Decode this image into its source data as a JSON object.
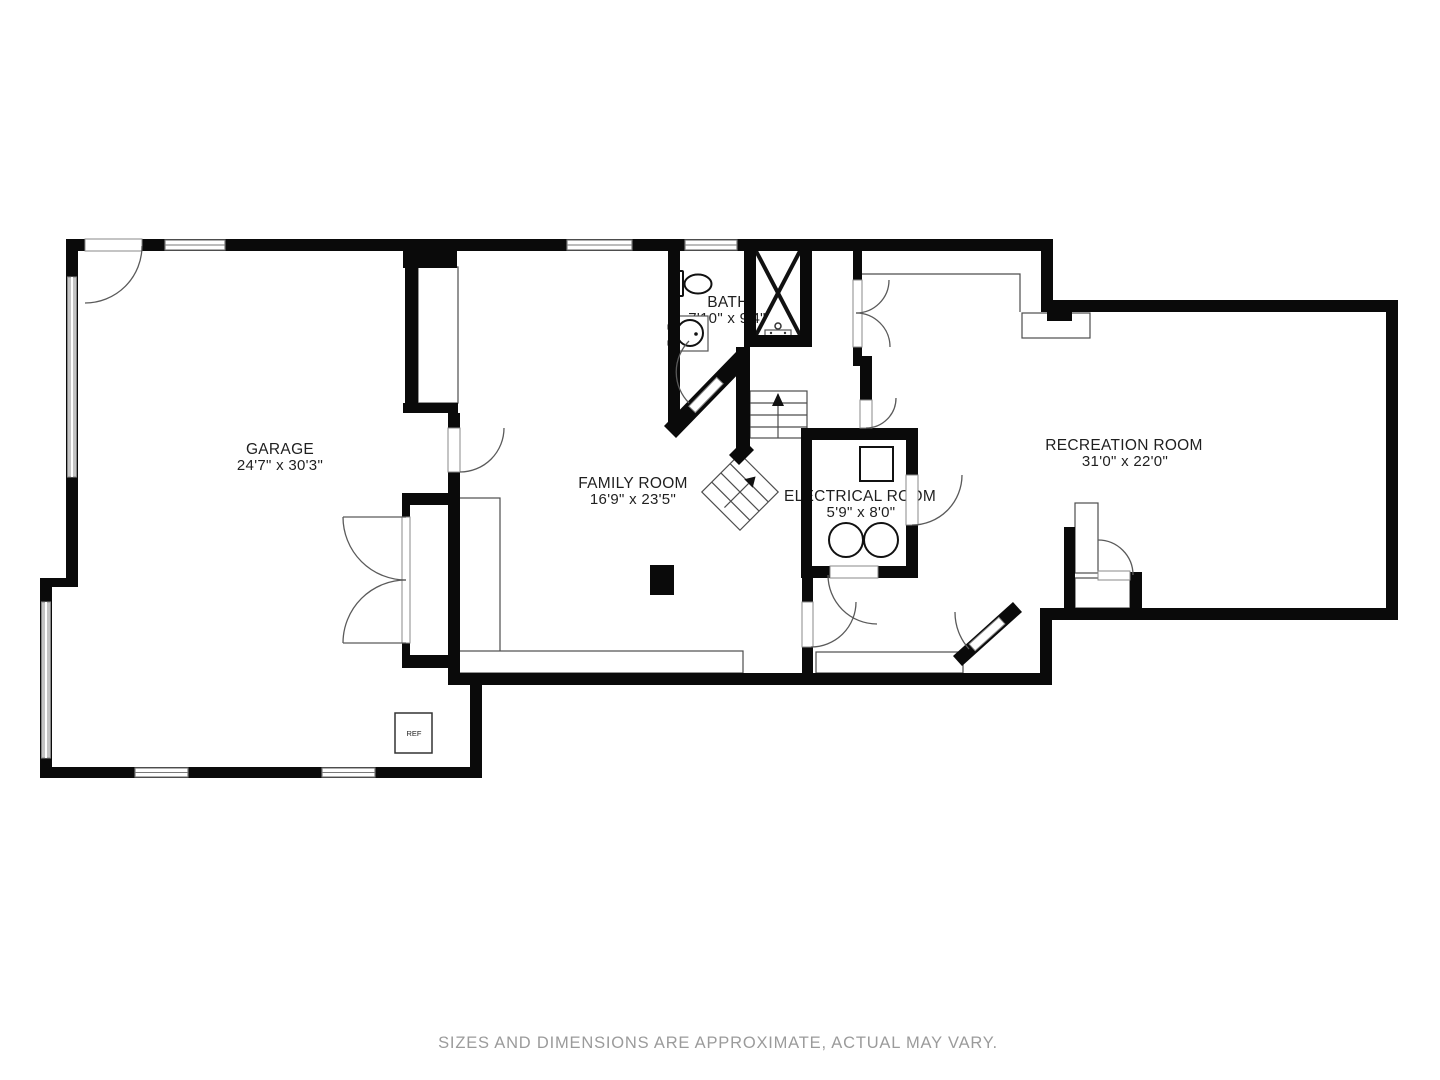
{
  "floor_plan": {
    "rooms": {
      "garage": {
        "label": "GARAGE",
        "dimensions": "24'7\" x 30'3\""
      },
      "family_room": {
        "label": "FAMILY ROOM",
        "dimensions": "16'9\" x 23'5\""
      },
      "bath": {
        "label": "BATH",
        "dimensions": "7'10\" x 9'4\""
      },
      "electrical_room": {
        "label": "ELECTRICAL ROOM",
        "dimensions": "5'9\" x 8'0\""
      },
      "recreation_room": {
        "label": "RECREATION ROOM",
        "dimensions": "31'0\" x 22'0\""
      }
    },
    "fixtures": {
      "refrigerator": "REF"
    },
    "disclaimer": "SIZES AND DIMENSIONS ARE APPROXIMATE, ACTUAL MAY VARY.",
    "colors": {
      "wall": "#0a0a0a",
      "thin_line": "#4d4d4d",
      "window_fill": "#c4c4c4",
      "label_text": "#1f1f1f",
      "disclaimer_text": "#9b9b9b",
      "background": "#ffffff"
    }
  }
}
